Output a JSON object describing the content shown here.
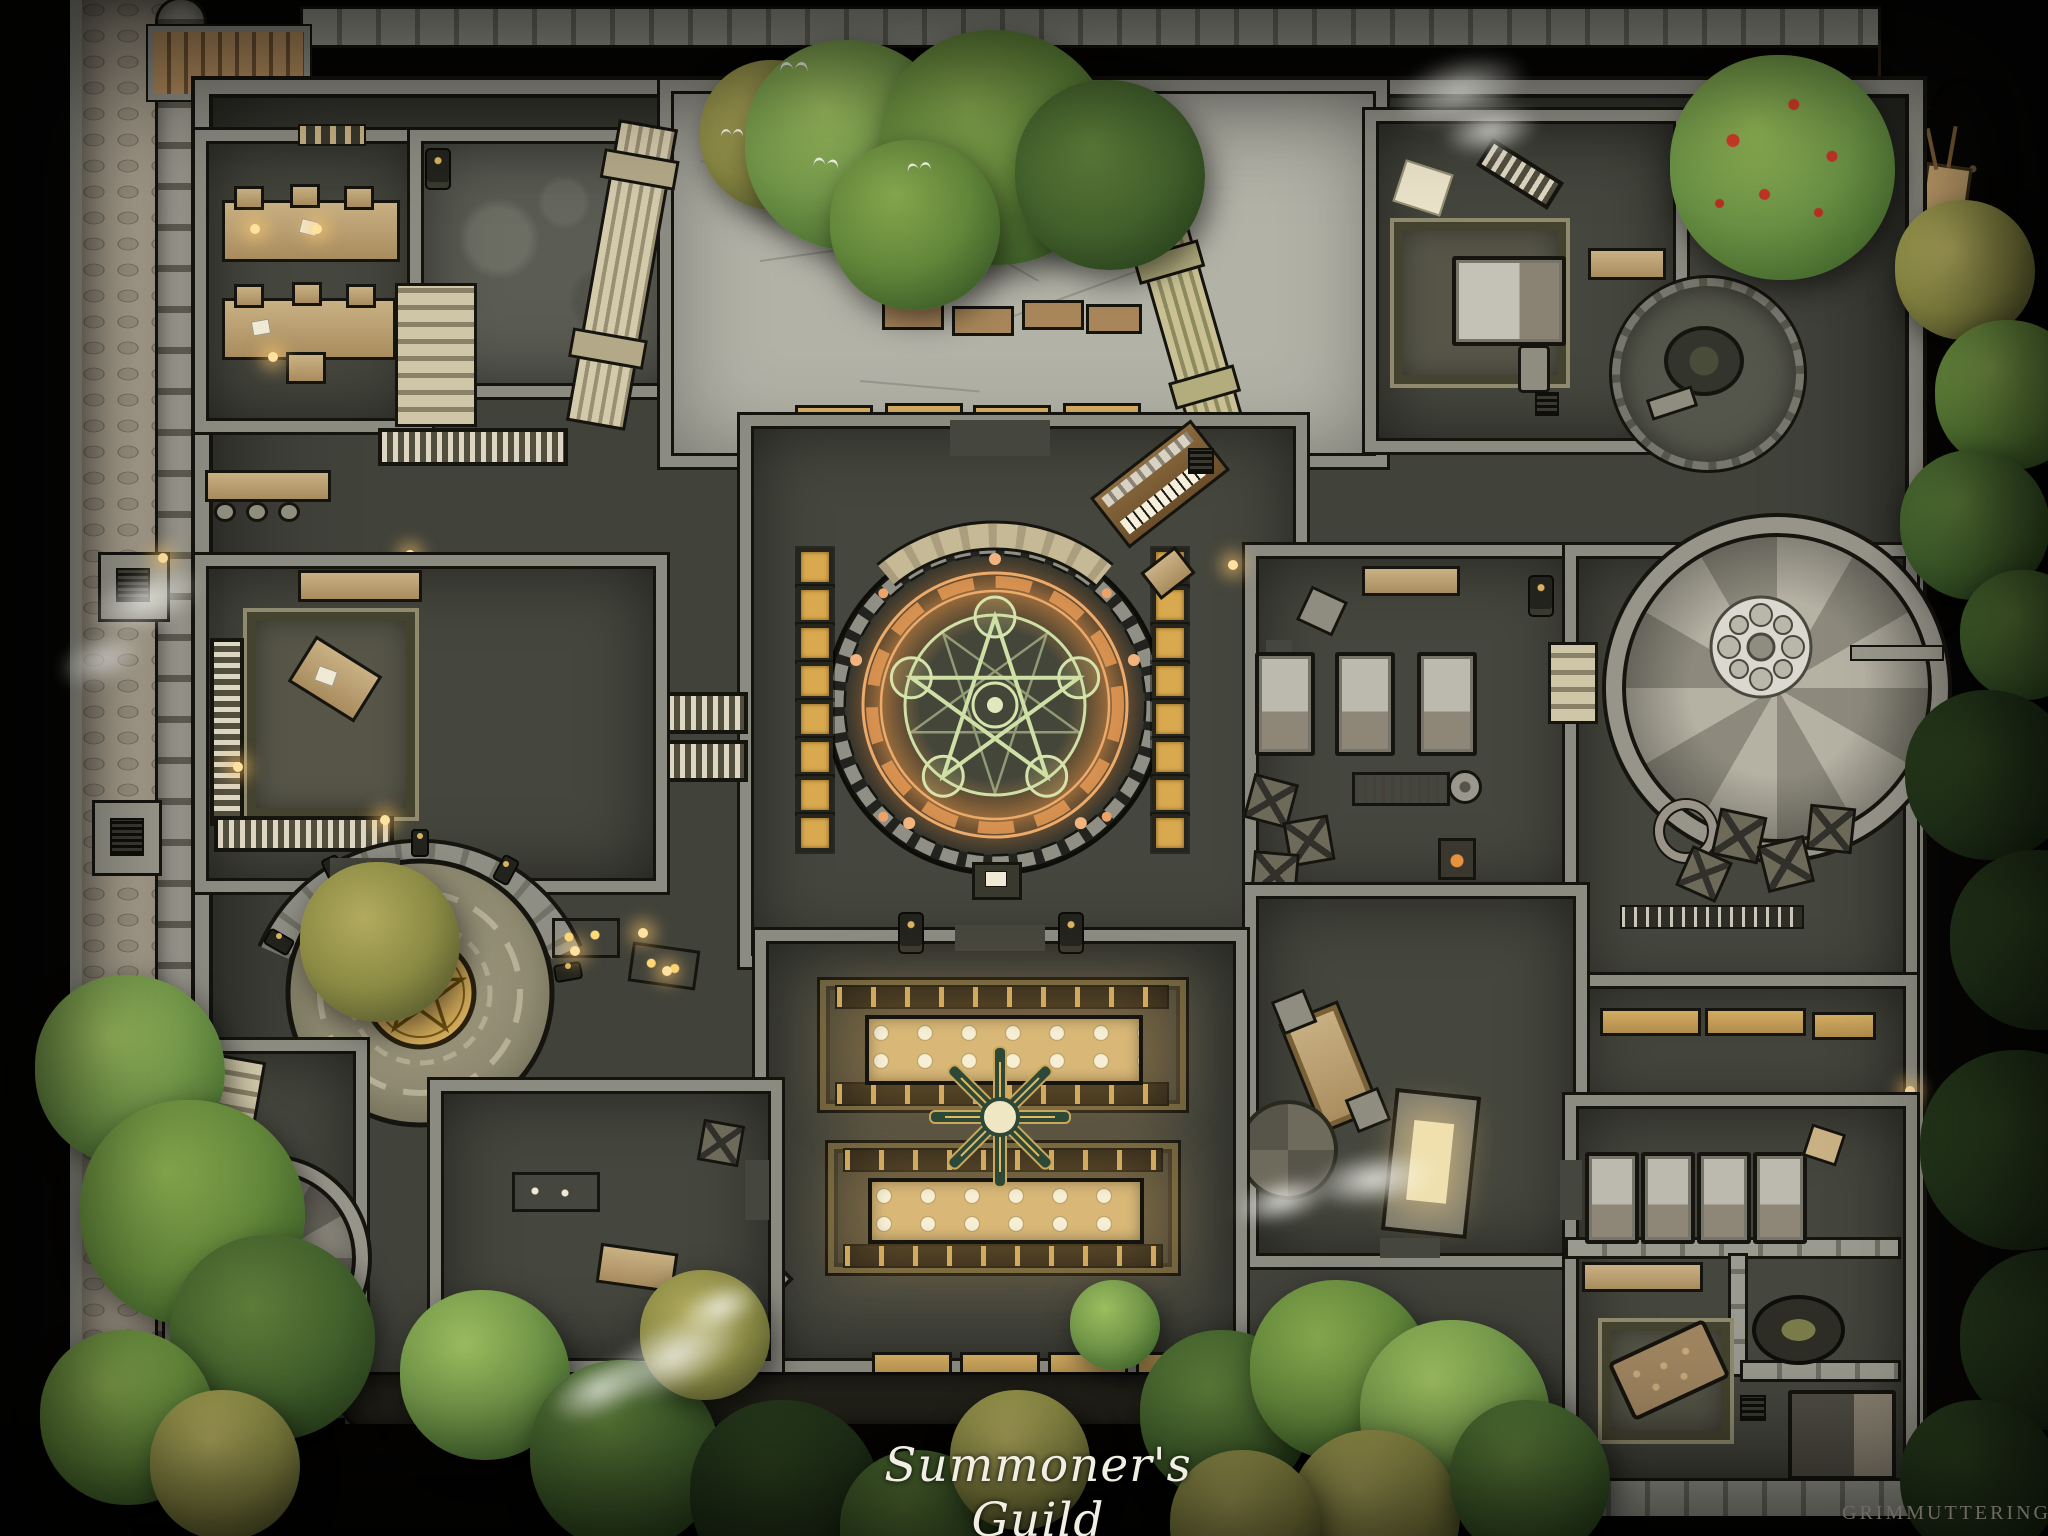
{
  "map": {
    "title": "Summoner's Guild",
    "watermark": "GRIMMUTTERINGS"
  },
  "palette": {
    "background": "#060504",
    "floor_dark": "#45463d",
    "floor_light": "#b2b2a7",
    "wall_stone": "#8b8b82",
    "outline_dark": "#14130e",
    "rock_ridge": "#96948a",
    "rampart_path": "#a89f8e",
    "wood_bridge": "#b08a5c",
    "tree_green": "#62873a",
    "tree_bright": "#74994a",
    "tree_dark": "#42612c",
    "tree_olive": "#8b8a44",
    "apple_red": "#cf3b28",
    "circle_orange_glow": "#e8a161",
    "circle_green_sigil": "#cfe0a6",
    "pentagram_gold": "#d6ae5c",
    "table_wood_glow": "#d9b877",
    "lantern_glow": "#ffe2a0",
    "fountain_teal": "#5cbfae",
    "dirt_path": "#a98e6d",
    "title_text": "#f1eee4",
    "watermark_text": "#6e6a60"
  },
  "features": [
    "rampart-walk",
    "rock-ridge",
    "wooden-bridge-north",
    "wooden-bridge-south",
    "entry-courtyard",
    "fountain",
    "fallen-columns",
    "courtyard-benches",
    "planter-boxes",
    "scriptorium-desks",
    "collapsed-hall",
    "wall-ladder",
    "switchback-stairs",
    "master-office",
    "office-rug",
    "library-shelves",
    "pipe-organ",
    "summoning-circle",
    "ritual-arc",
    "ritual-lectern",
    "ritual-chairs",
    "guard-statues",
    "pentagram-dais",
    "dais-statues",
    "treasure-tables",
    "spiral-staircase",
    "stair-rosette",
    "crate-stack",
    "rope-coil",
    "dormitory-beds",
    "workbench",
    "grindstone",
    "furnace",
    "round-table-nook",
    "apple-tree",
    "hillside-path",
    "hand-cart",
    "exterior-steps",
    "banquet-hall",
    "feast-tables",
    "plate-settings",
    "star-centerpiece",
    "feast-benches",
    "chimney-vent",
    "chimney-smoke",
    "storage-room",
    "bedroom-beds",
    "couch",
    "couch-rug",
    "cauldron",
    "sleeping-bed",
    "writing-desk",
    "round-rug",
    "glowing-shrine",
    "tower-stairs",
    "hanging-pennant",
    "birds",
    "forest-edge"
  ]
}
